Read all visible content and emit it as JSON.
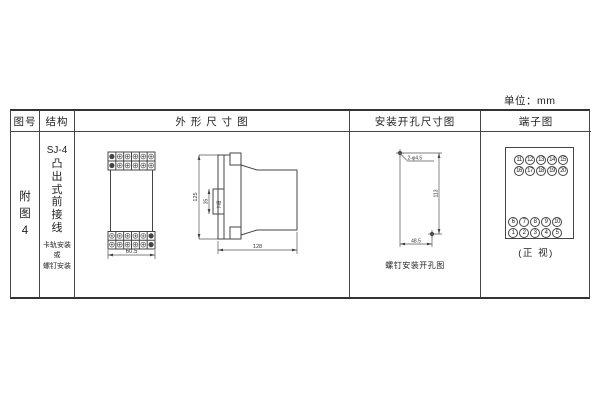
{
  "unit_label": "单位：mm",
  "table": {
    "headers": {
      "figure_no": "图号",
      "structure": "结构",
      "outline": "外 形 尺 寸 图",
      "mounting": "安装开孔尺寸图",
      "terminal": "端子图"
    },
    "figure_no": "附图4",
    "structure": {
      "model": "SJ-4",
      "type_vertical": "凸出式前接线",
      "mount_lines": [
        "卡轨安装",
        "或",
        "螺钉安装"
      ]
    }
  },
  "outline_drawing": {
    "front_view": {
      "width_dim": "60.5"
    },
    "side_view": {
      "height_dim": "125",
      "slot_dim": "35",
      "slot_label": "卡槽",
      "depth_dim": "128"
    }
  },
  "mounting_drawing": {
    "holes_label": "2-φ4.5",
    "vertical_dim": "113",
    "horizontal_dim": "48.5",
    "caption": "螺钉安装开孔图"
  },
  "terminal_diagram": {
    "top_group": {
      "rows": [
        [
          "11",
          "12",
          "13",
          "14",
          "15"
        ],
        [
          "16",
          "17",
          "18",
          "19",
          "20"
        ]
      ]
    },
    "bottom_group": {
      "rows": [
        [
          "6",
          "7",
          "8",
          "9",
          "10"
        ],
        [
          "1",
          "2",
          "3",
          "4",
          "5"
        ]
      ]
    },
    "caption": "(正 视)"
  },
  "colors": {
    "line": "#444444",
    "text": "#222222",
    "background": "#ffffff"
  }
}
